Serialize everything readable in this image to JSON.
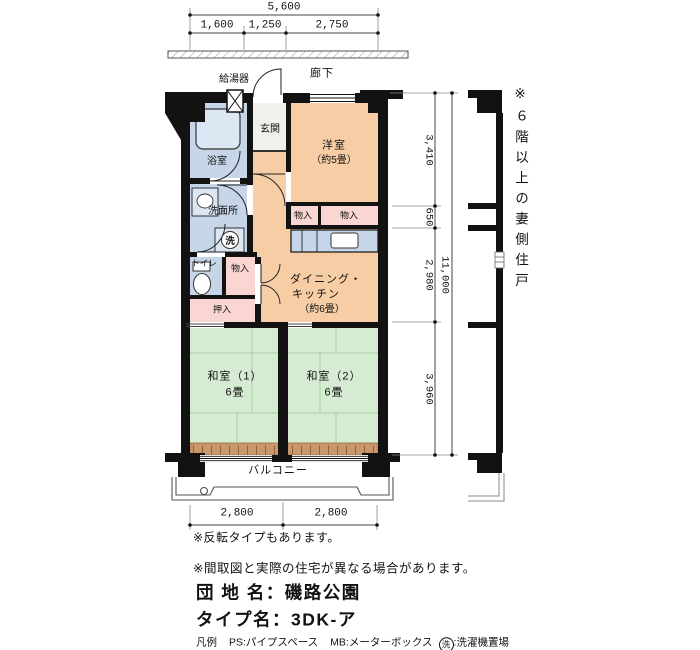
{
  "colors": {
    "wall": "#121212",
    "room_peach": "#f6cda5",
    "room_green": "#d6ecd2",
    "room_blue": "#c6d5e8",
    "room_pink": "#f9d6d2",
    "sill_tan": "#c9996c",
    "dim_line": "#444444"
  },
  "top_dimensions": {
    "total": "5,600",
    "segments": [
      "1,600",
      "1,250",
      "2,750"
    ]
  },
  "upper_labels": {
    "corridor": "廊下",
    "water_heater": "給湯器"
  },
  "rooms": {
    "entrance": "玄関",
    "western_room_line1": "洋室",
    "western_room_line2": "（約5畳）",
    "bath": "浴室",
    "washroom": "洗面所",
    "toilet": "トイレ",
    "storage_top_left": "物入",
    "storage_top_right": "物入",
    "storage_mid": "物入",
    "closet": "押入",
    "dk_line1": "ダイニング・",
    "dk_line2": "キッチン",
    "dk_line3": "（約6畳）",
    "tatami1_line1": "和室（1）",
    "tatami1_line2": "6畳",
    "tatami2_line1": "和室（2）",
    "tatami2_line2": "6畳",
    "balcony": "バルコニー",
    "laundry_symbol": "洗"
  },
  "right_dimensions": {
    "segments": [
      "3,410",
      "650",
      "2,980",
      "3,960"
    ],
    "total": "11,000"
  },
  "side_note": "※６階以上の妻側住戸",
  "bottom_dimensions": [
    "2,800",
    "2,800"
  ],
  "notes": [
    "※反転タイプもあります。",
    "※間取図と実際の住宅が異なる場合があります。"
  ],
  "titles": {
    "estate_label": "団 地 名",
    "separator": "：",
    "estate_value": "磯路公園",
    "type_label": "タイプ名",
    "type_value": "3DK-ア"
  },
  "legend": {
    "title": "凡例",
    "ps": "PS:パイプスペース",
    "mb": "MB:メーターボックス",
    "laundry_symbol": "洗",
    "laundry_text": ":洗濯機置場"
  }
}
